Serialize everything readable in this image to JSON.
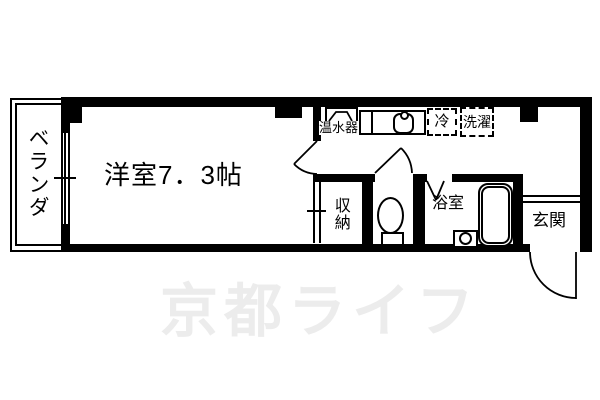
{
  "floorplan": {
    "rooms": {
      "veranda": "ベランダ",
      "main": "洋室7．3帖",
      "closet": "収納",
      "bath": "浴室",
      "entrance": "玄関"
    },
    "equipment": {
      "water_heater": "温水器",
      "fridge": "冷",
      "washer": "洗濯"
    },
    "watermark": "京都ライフ",
    "colors": {
      "wall": "#000000",
      "background": "#ffffff",
      "watermark": "#ececec"
    }
  }
}
